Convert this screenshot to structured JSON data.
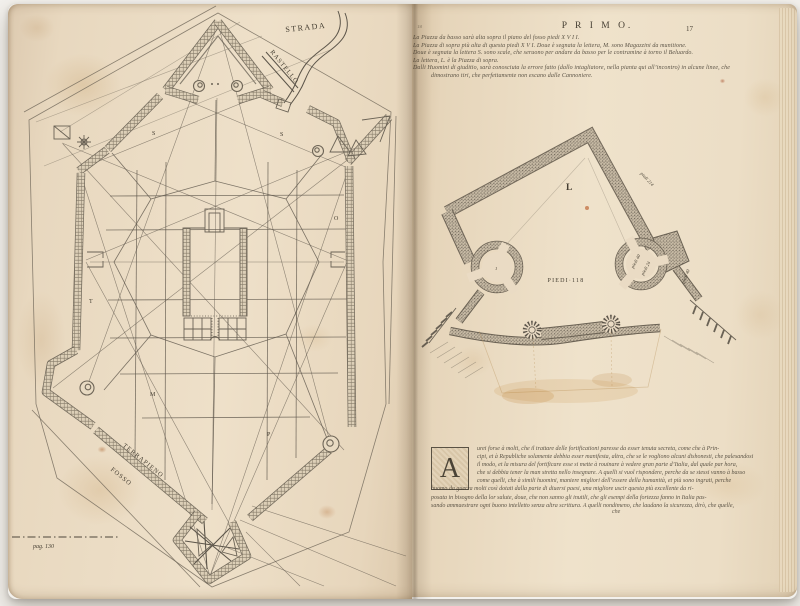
{
  "photo": {
    "background_color": "#f3f1ed"
  },
  "book": {
    "paper_color": "#eadcc4",
    "ink_color": "#463f33",
    "left_page": {
      "figure": "star-fortress-town-plan",
      "labels": {
        "strada": "STRADA",
        "rastello": "RASTELLO",
        "terrapieno": "TERRAPIENO",
        "fosso": "FOSSO"
      },
      "plan_letters": {
        "s1": "S",
        "s2": "S",
        "o": "O",
        "t": "T",
        "m": "M",
        "p": "P"
      },
      "page_ref": "pag. 130"
    },
    "right_page": {
      "header": {
        "signature": "18",
        "running_title": "P R I M O.",
        "folio": "17"
      },
      "intro_lines": [
        "La Piazza da basso sarà alta sopra il piano del fosso piedi    X V I I.",
        "La Piazza di sopra più alta di questa piedi   X V I.   Doue è segnata la lettera, M. sono Magazzini da munitione.",
        "Doue è segnata la lettera S. sono scale, che seruono per andare da basso per le contramine à torno il Beluardo.",
        "La lettera, L. è la Piazza di sopra.",
        "Dalli Huomini di giuditio, sarà conosciuta la errore fatto (dallo intagliatore, nella pianta qui all’incontro) in alcune linee, che",
        "dimostrano tiri, che perfettamente non escano dalle Cannoniere."
      ],
      "diagram": {
        "figure": "bastion-detail-plan",
        "labels": {
          "piazza": "L",
          "base_width": "PIEDI·118",
          "face_length": "piedi 214",
          "wall": "piedi 40",
          "tower_a": "piedi 40",
          "tower_b": "piedi 24",
          "tower_left_mark": "1"
        }
      },
      "paragraph": {
        "initial": "A",
        "lines": [
          "urei forse à molti, che il trattare delle fortificationi paresse da esser tenuta secreta, come che à Prin-",
          "cipi, et à Republiche solamente debbia esser manifesta, altra, che se le vogliono alcuni dishonesti, che palesandosi",
          "il modo, et la misura del fortificare esse si mette à rouinare à vedere gran parte d’Italia, dal quale par hora,",
          "che si debbia tener la man stretta nello insegnare.   A quelli si vuol rispondere, perche da se stessi vanno à basso",
          "come quelli, che à simili huomini, maniere migliori dell’essere della humanità, et più sono ingrati, perche",
          "huomo da guerra molti così dotati dalla parte di diuersi paesi, una migliore uscir questa più excellente da ri-",
          "posata in bisogno della lor salute, doue, che non sanno gli inutili, che gli esempi della fortezza fanno in Italia pas-",
          "sando ammaestrare ogni buono intelletto senza altra scrittura.   A quelli nondimeno, che laudano la sicurezza, dirò, che quelle,"
        ],
        "catchword": "che"
      }
    }
  }
}
